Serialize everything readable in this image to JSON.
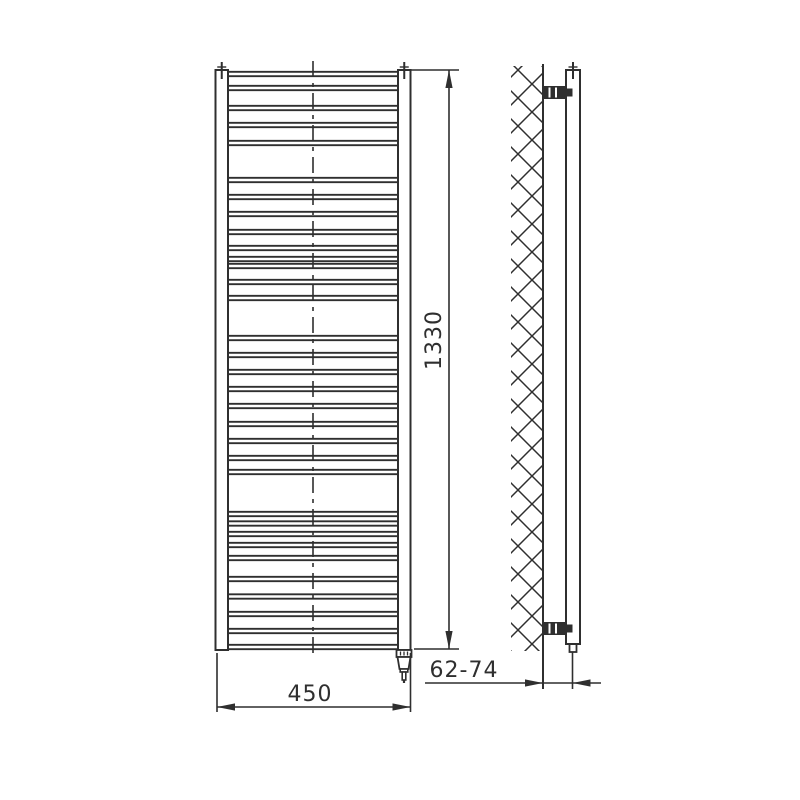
{
  "drawing": {
    "title": "ladder towel radiator technical drawing (front view and wall-mount side view)",
    "dimensions": {
      "height": {
        "label": "1330"
      },
      "width": {
        "label": "450"
      },
      "wall_distance": {
        "label": "62-74"
      }
    },
    "colors": {
      "line": "#2f2f2f",
      "background": "#ffffff"
    }
  },
  "geometry": {
    "front": {
      "left_rail": {
        "x": 215.5,
        "top": 70,
        "bottom": 650,
        "w": 12.5
      },
      "right_rail": {
        "x": 398,
        "top": 70,
        "bottom": 650,
        "w": 12.5
      },
      "rung_x1": 228,
      "rung_x2": 398,
      "rung_half_gap": 2.2,
      "centerline": {
        "x": 313,
        "y1": 61,
        "y2": 658
      },
      "cap_ticks_x": [
        221.75,
        404.25
      ],
      "cap_tick": {
        "y1": 62,
        "y2": 79,
        "bar_y": 67,
        "bar_half": 4.5
      },
      "rungs": [
        74,
        88,
        108,
        125,
        143,
        180,
        197,
        214,
        232,
        248,
        259,
        266,
        282,
        298,
        338,
        355,
        372,
        389,
        406,
        424,
        441,
        458,
        472,
        514,
        523.5,
        534,
        545,
        558,
        579,
        596.5,
        614,
        631,
        647
      ],
      "element": {
        "cx": 404
      }
    },
    "side": {
      "hatch": {
        "x": 511,
        "y": 66,
        "w": 32,
        "h": 585,
        "cell": 28
      },
      "wall_line": {
        "x": 543,
        "y1": 64,
        "y2": 689
      },
      "tube": {
        "x1": 566,
        "x2": 580,
        "top": 70,
        "bottom": 644
      },
      "tube_foot": {
        "x1": 569.5,
        "x2": 576.5,
        "bottom": 652
      },
      "cap_tick_x": 573,
      "brackets_y": [
        86,
        622
      ],
      "bracket": {
        "x1": 543,
        "w": 23,
        "h": 13,
        "slits": [
          549.5,
          556
        ],
        "nub_w": 6.5
      }
    },
    "dims": {
      "height": {
        "x": 449,
        "y1": 70,
        "y2": 649,
        "ext_top": {
          "x1": 411,
          "x2": 459,
          "y": 70
        },
        "ext_bot": {
          "x1": 414,
          "x2": 459,
          "y": 649
        }
      },
      "width": {
        "y": 707,
        "x1": 217,
        "x2": 410.5,
        "ext_y1": 653,
        "ext_y2": 712
      },
      "depth": {
        "y": 683,
        "x1": 425,
        "x2": 601,
        "tip1": 543,
        "tip2": 572.5,
        "ext2": {
          "x": 572.5,
          "y1": 652,
          "y2": 689
        }
      },
      "arrow": {
        "len": 18,
        "hw": 3.6
      }
    }
  }
}
